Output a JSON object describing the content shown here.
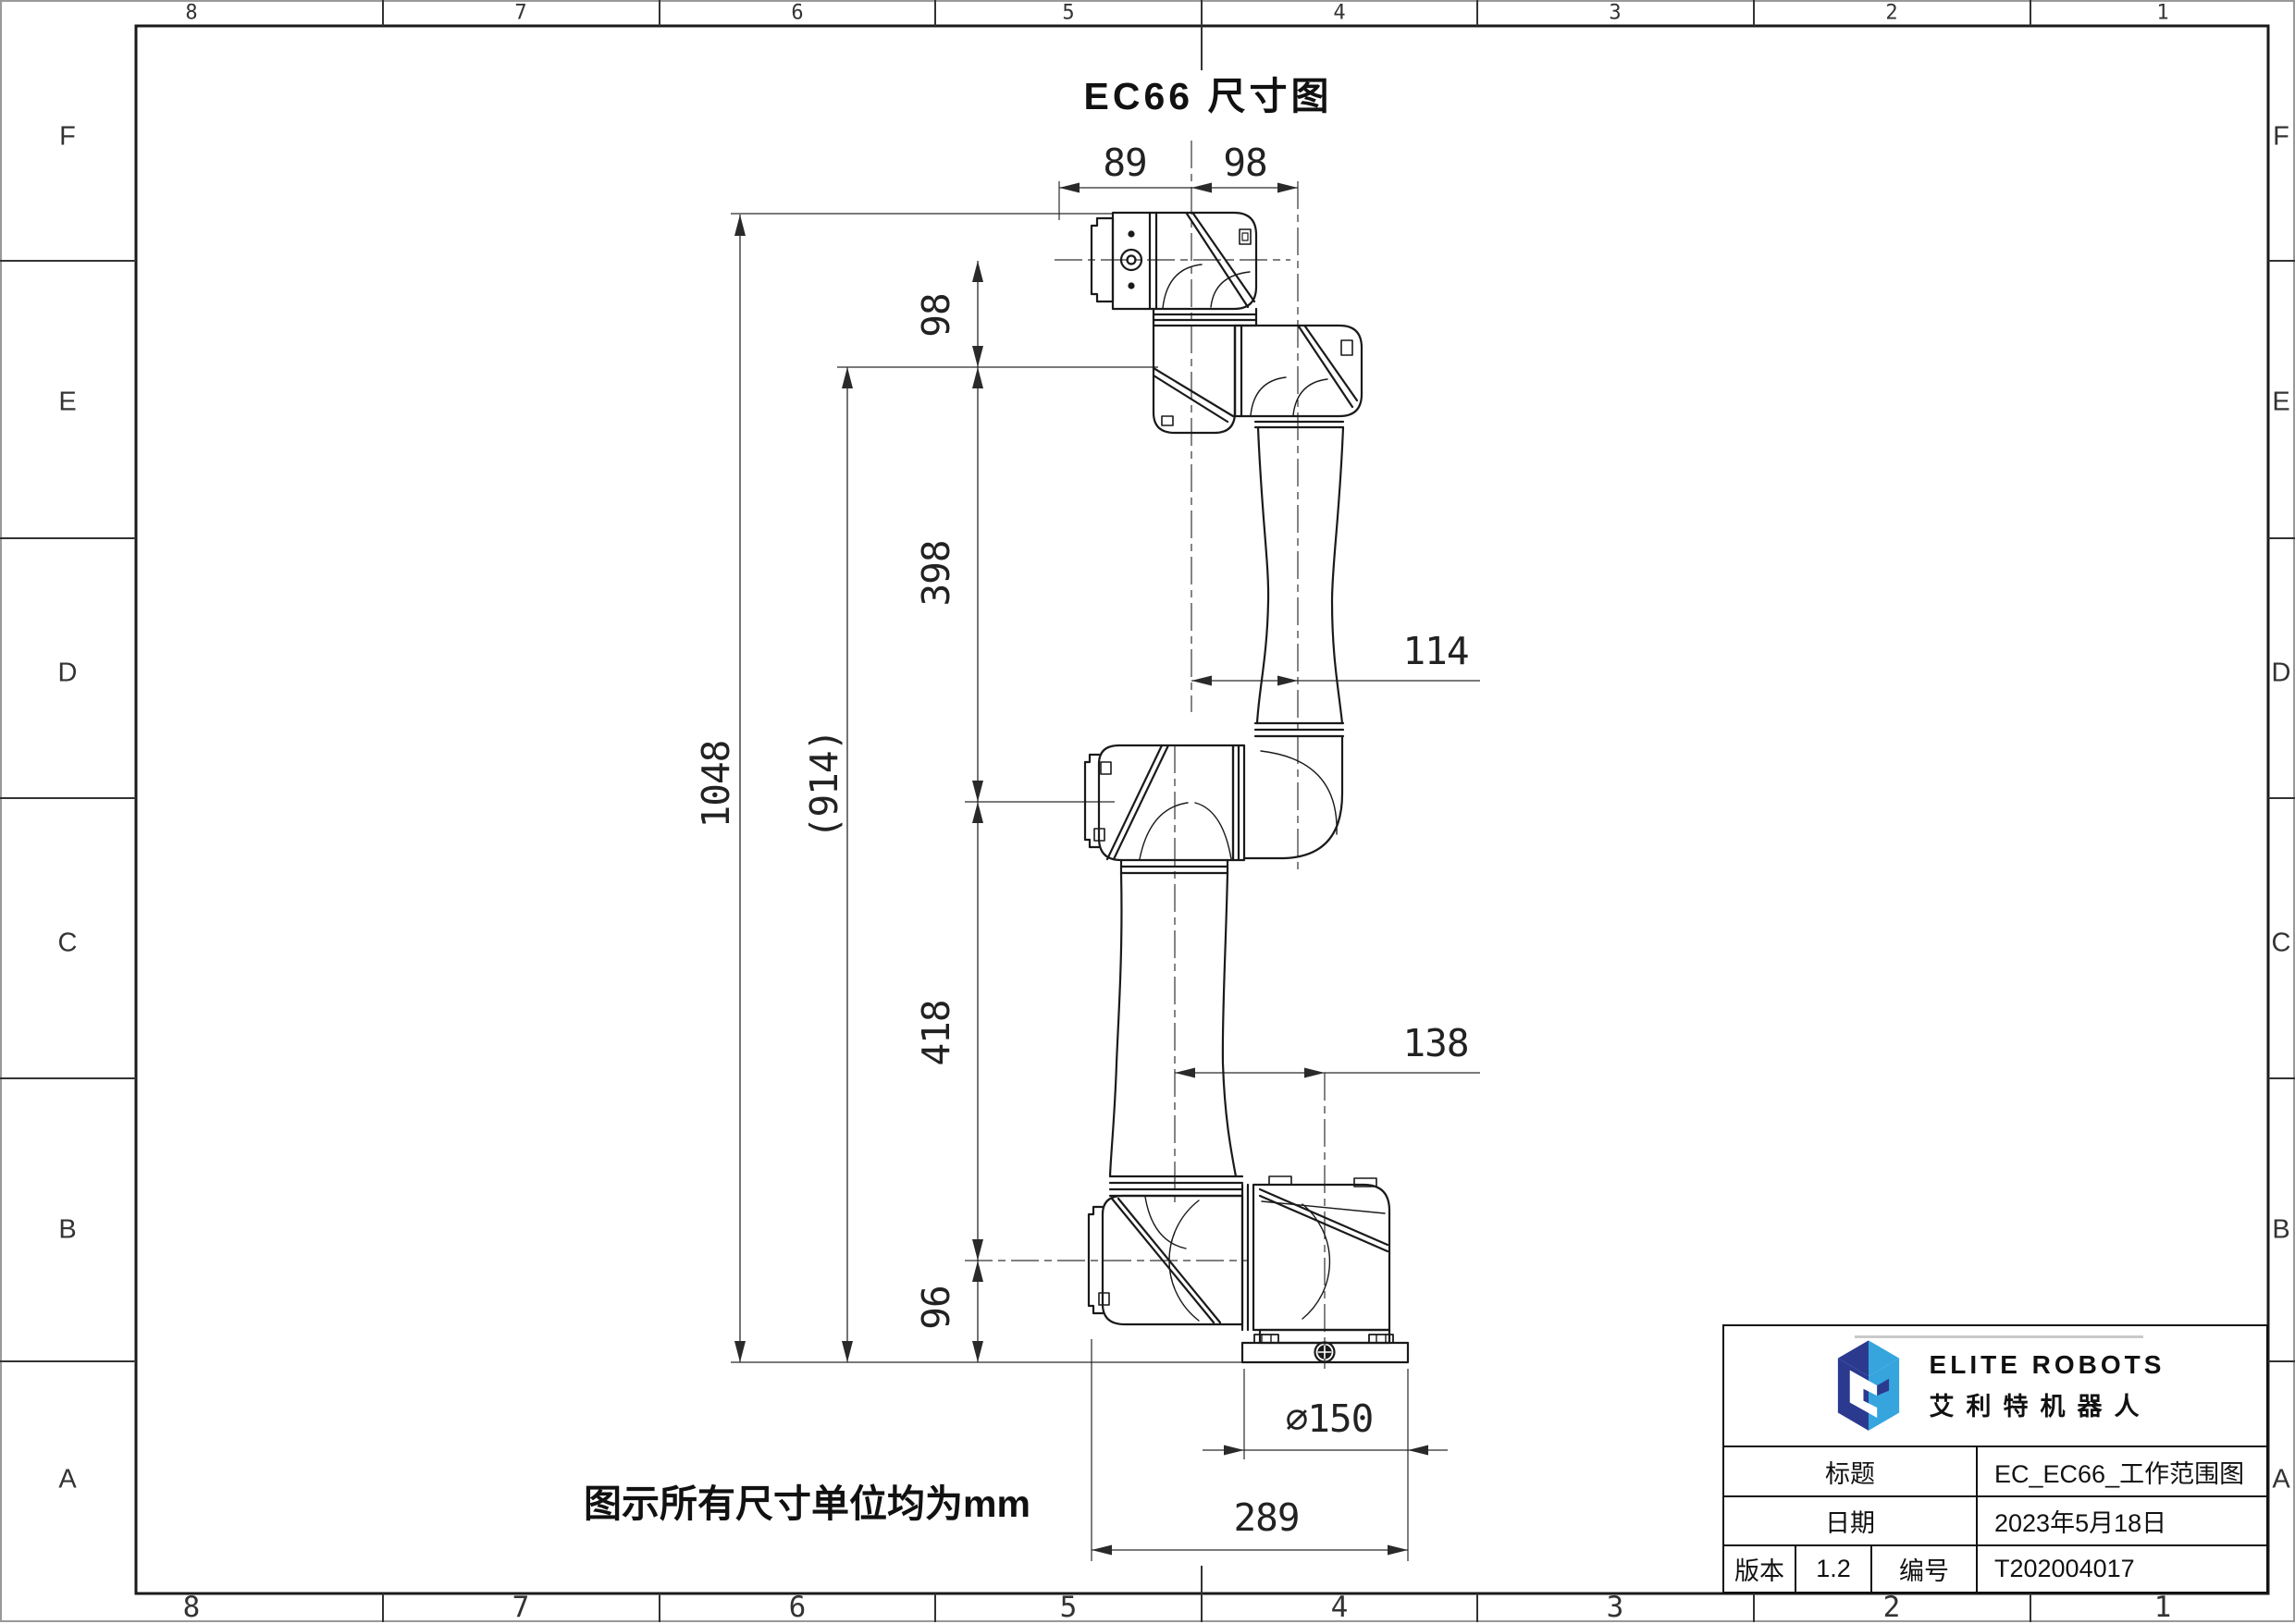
{
  "sheet": {
    "zones_top": [
      "8",
      "7",
      "6",
      "5",
      "4",
      "3",
      "2",
      "1"
    ],
    "zones_bottom": [
      "8",
      "7",
      "6",
      "5",
      "4",
      "3",
      "2",
      "1"
    ],
    "zones_left": [
      "F",
      "E",
      "D",
      "C",
      "B",
      "A"
    ],
    "zones_right": [
      "F",
      "E",
      "D",
      "C",
      "B",
      "A"
    ]
  },
  "drawing": {
    "title": "EC66 尺寸图",
    "note": "图示所有尺寸单位均为mm",
    "dims": {
      "d89": "89",
      "d98_top": "98",
      "d98_left": "98",
      "d398": "398",
      "d418": "418",
      "d96": "96",
      "d1048": "1048",
      "d914": "(914)",
      "d114": "114",
      "d138": "138",
      "d150": "∅150",
      "d289": "289"
    }
  },
  "title_block": {
    "company_en": "ELITE ROBOTS",
    "company_cn": "艾利特机器人",
    "row_title": {
      "label": "标题",
      "value": "EC_EC66_工作范围图"
    },
    "row_date": {
      "label": "日期",
      "value": "2023年5月18日"
    },
    "row_version": {
      "label": "版本",
      "value": "1.2",
      "label2": "编号",
      "value2": "T202004017"
    }
  },
  "colors": {
    "line": "#1a1a1a",
    "logo_dark_blue": "#2b3a8f",
    "logo_light_blue": "#36a5de"
  }
}
